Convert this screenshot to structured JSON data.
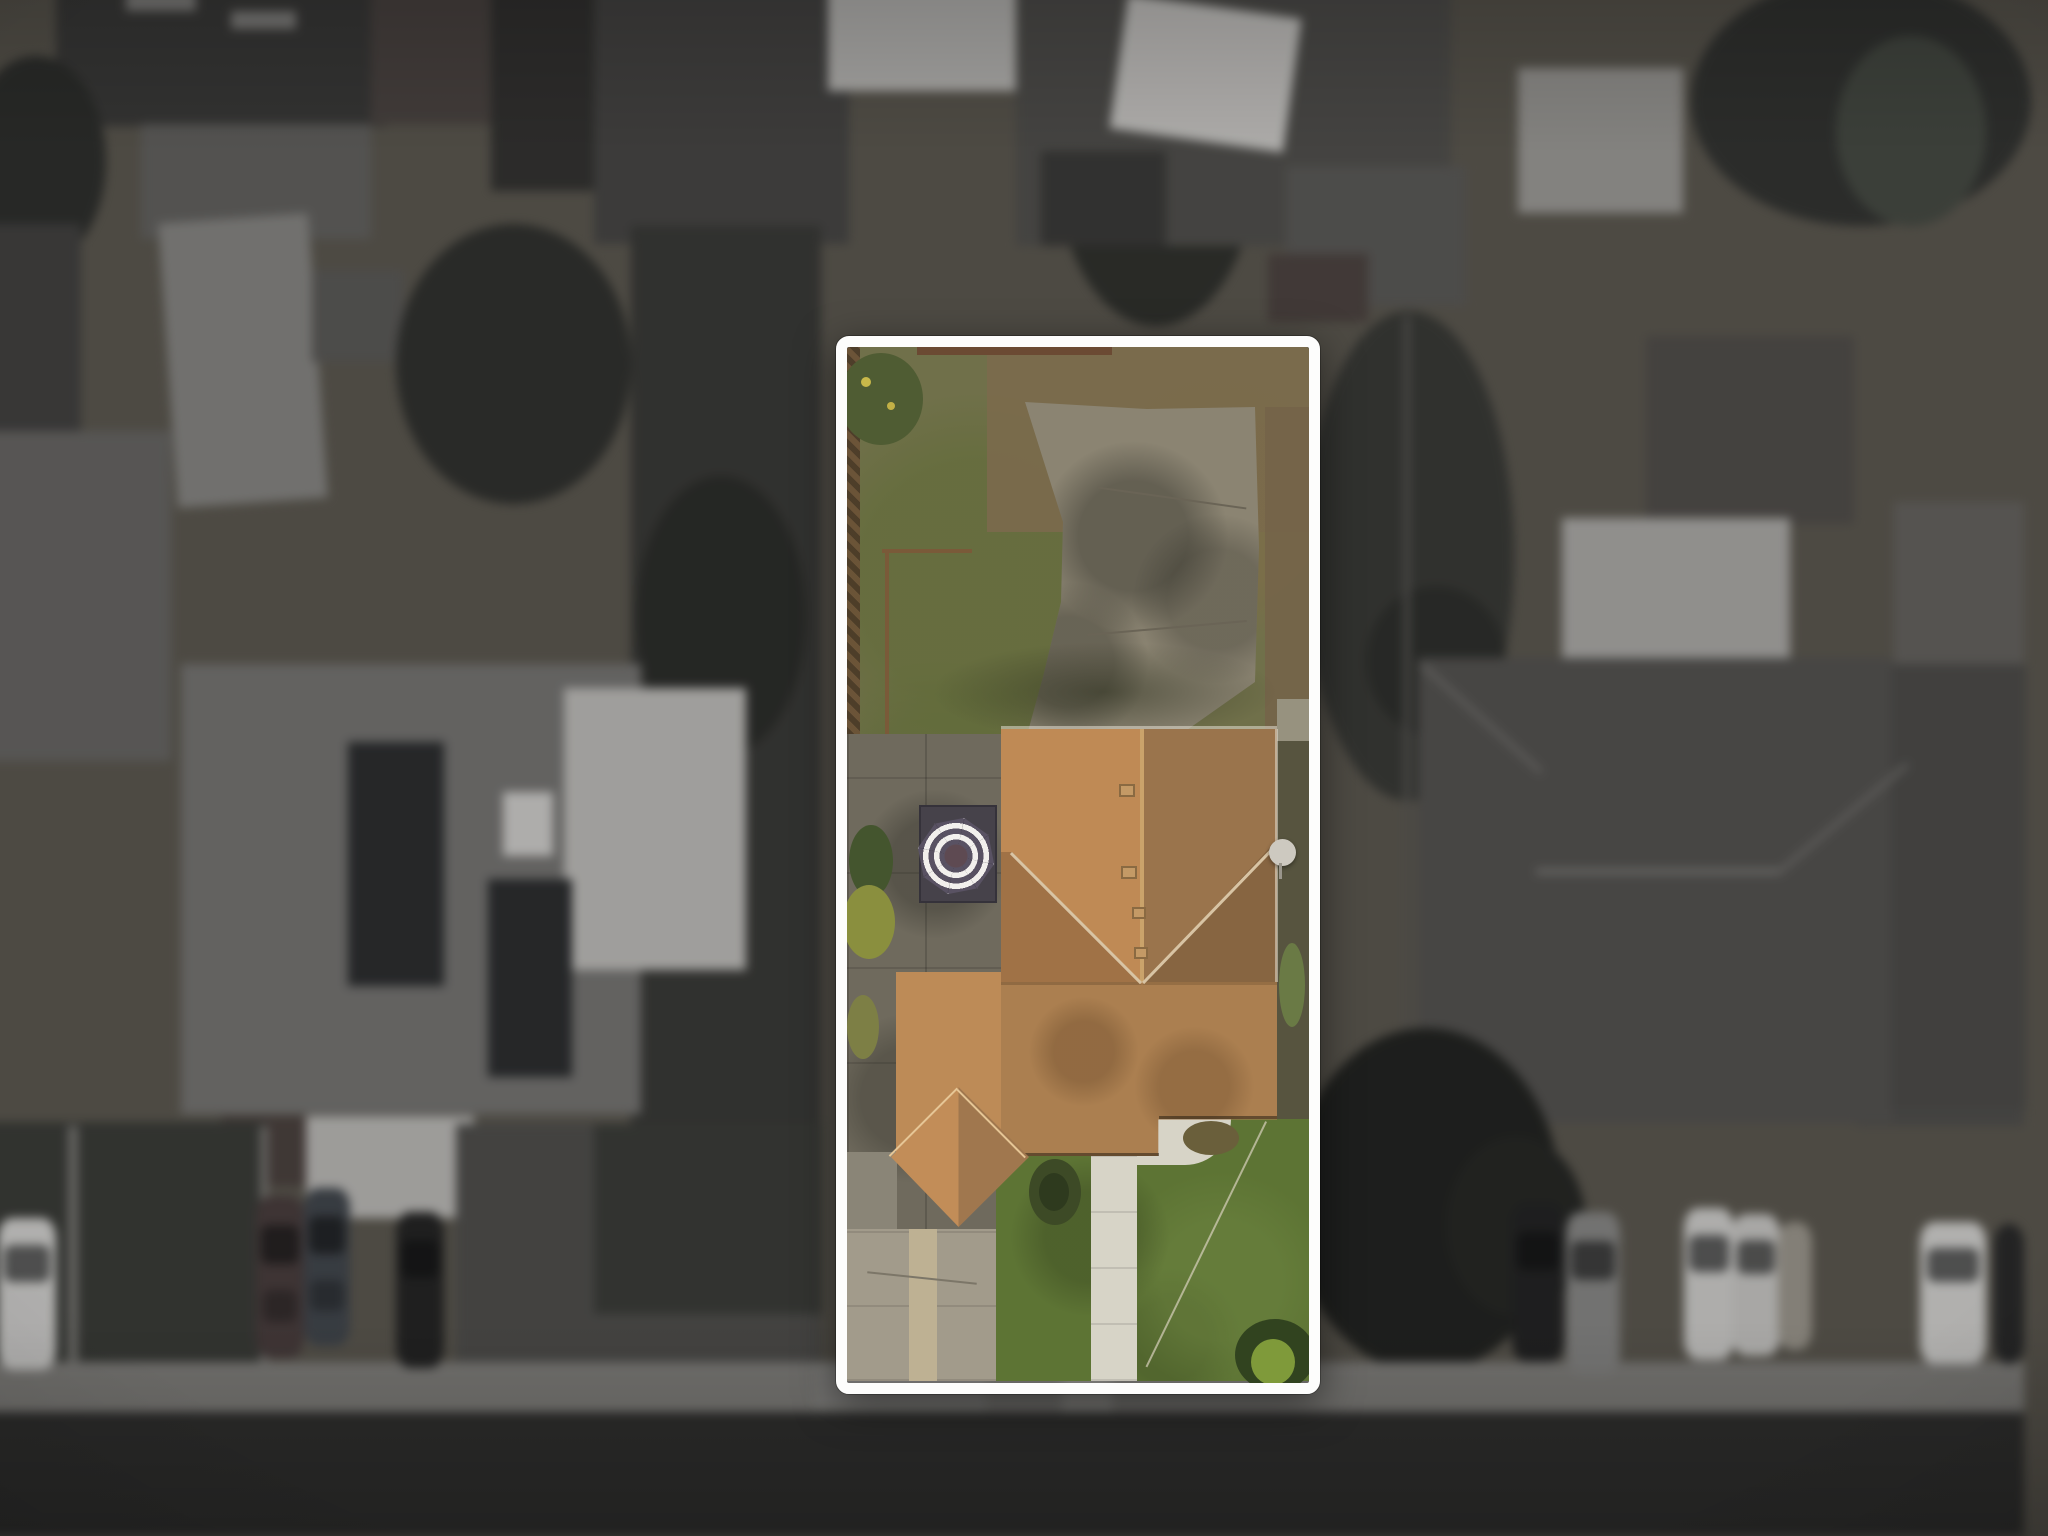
{
  "scene": {
    "type": "aerial-drone-photograph",
    "description": "Top-down aerial photo of a suburban block. One rectangular residential parcel is highlighted in full color and outlined in white; all surrounding properties are blurred, desaturated and dimmed.",
    "highlight_outline": {
      "color": "#fdfdfc",
      "thickness_px": 11,
      "corner_radius_px": 13
    }
  },
  "lot": {
    "backyard": {
      "lawn_color": "#70704a",
      "dead_grass_color": "#7b6a4c",
      "concrete_pad_color": "#8b8472",
      "garden_edging_color": "#7a5a39",
      "shrub": "green bush with yellow blooms (top-left corner)",
      "fence_strip": "wooden fence shadow along left boundary"
    },
    "patio": {
      "concrete_color": "#6f6a5d",
      "mat_color": "#46424a",
      "umbrella": {
        "shape": "octagonal market umbrella, concentric stripes",
        "stripe_light": "#f2f0ed",
        "stripe_dark": "#595263",
        "center_color": "#5e4a52"
      }
    },
    "house": {
      "roof_material": "asphalt shingle",
      "roof_light": "#bf8a55",
      "roof_dark": "#9a744c",
      "ridge_color": "#caa36b",
      "valley_color": "#d8c4a4",
      "roof_vents": 4,
      "satellite_dish_color": "#cdc9c0",
      "entry_gable": "hipped porch gable protruding toward driveway"
    },
    "front_yard": {
      "lawn_color": "#5d7434",
      "walkway_color": "#d7d4c7",
      "driveway_color": "#a29b8b",
      "driveway_accent": "#beb193",
      "door_bush_color": "#3d4a26",
      "corner_bush": "dark green shrub with bright yellow-green leaves (bottom-right)",
      "garden_hose_line": "#d8d2bd"
    }
  },
  "street": {
    "asphalt_color": "#33332f",
    "sidewalk_color": "#89857b"
  },
  "vehicles": {
    "left_curb": [
      "white",
      "maroon",
      "dark-blue",
      "black"
    ],
    "right_curb": [
      "black",
      "gray",
      "white",
      "white",
      "tan"
    ],
    "far_right": [
      "white",
      "dark"
    ]
  },
  "neighborhood_features": [
    "solar-panel arrays on gray roof (left)",
    "white flat roof section (left)",
    "skylight (left roof)",
    "large light warehouse roof (mid-left)",
    "dark hip-roof house with white gable (top-center)",
    "apartment building with white canopy (top-right)",
    "light trellis grid (top-right)",
    "palm tree (top-right)",
    "brown shed and light outbuilding (right)",
    "large taupe hip-roof house (right)",
    "dark street tree canopy (bottom-right)",
    "hedges and fence posts (bottom-left)",
    "red-brown roof house (bottom-left)"
  ],
  "palette": {
    "background_base": "#4d4a43",
    "background_tree": "#30342a",
    "background_roof_light": "#c6c2b9",
    "solar_panel": "#2b3035"
  }
}
